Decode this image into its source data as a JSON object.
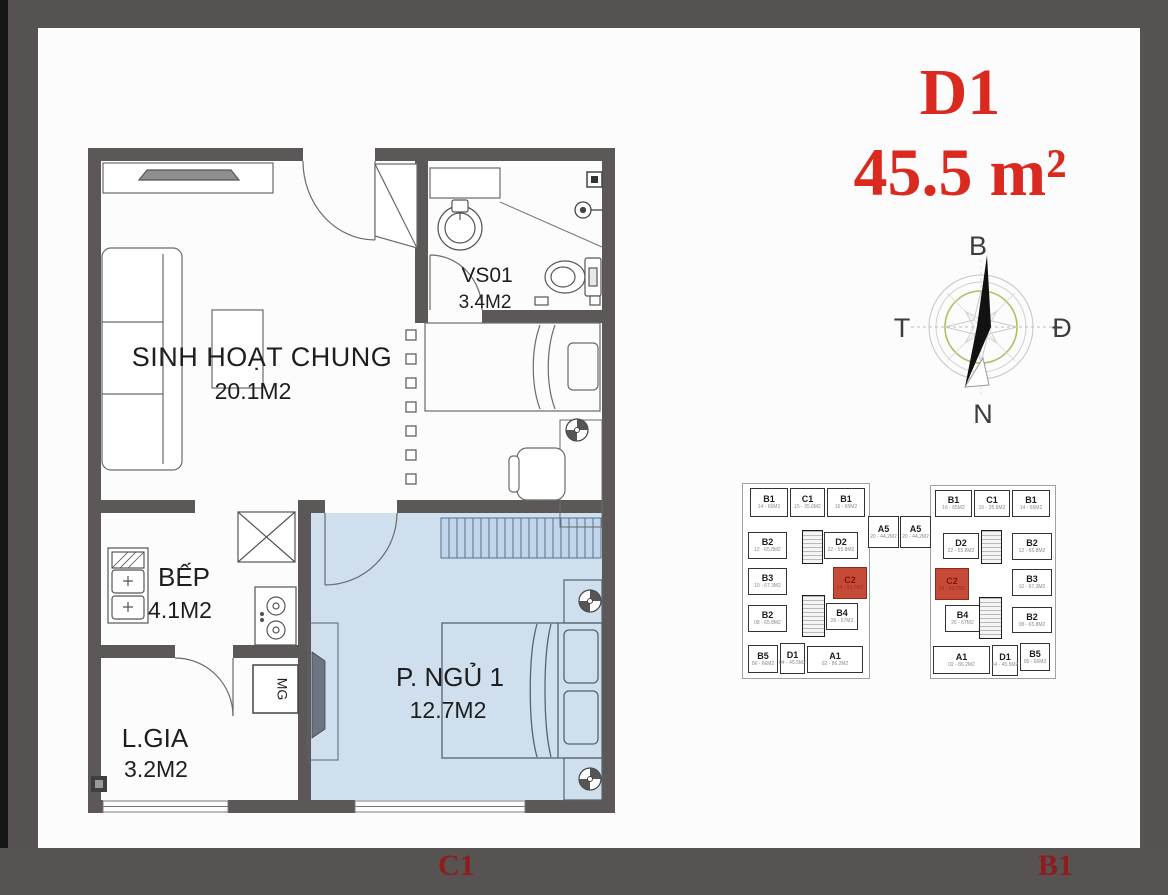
{
  "title": {
    "unit": "D1",
    "area": "45.5 m²"
  },
  "compass": {
    "north": "B",
    "east": "Đ",
    "south": "N",
    "west": "T"
  },
  "floorplan": {
    "rooms": [
      {
        "name": "SINH HOẠT CHUNG",
        "area": "20.1M2"
      },
      {
        "name": "VS01",
        "area": "3.4M2"
      },
      {
        "name": "BẾP",
        "area": "4.1M2"
      },
      {
        "name": "L.GIA",
        "area": "3.2M2"
      },
      {
        "name": "P. NGỦ 1",
        "area": "12.7M2"
      }
    ],
    "appliance_label": "MG"
  },
  "keyplan": {
    "cells": [
      {
        "t": "u",
        "label": "B1",
        "sub": "14 - 65M2",
        "x": 12,
        "y": 5,
        "w": 38,
        "h": 29
      },
      {
        "t": "u",
        "label": "C1",
        "sub": "15 - 35.6M2",
        "x": 52,
        "y": 5,
        "w": 35,
        "h": 29
      },
      {
        "t": "u",
        "label": "B1",
        "sub": "16 - 65M2",
        "x": 89,
        "y": 5,
        "w": 38,
        "h": 29
      },
      {
        "t": "u",
        "label": "B2",
        "sub": "12 - 65.8M2",
        "x": 10,
        "y": 49,
        "w": 39,
        "h": 27
      },
      {
        "t": "core",
        "x": 64,
        "y": 47,
        "w": 21,
        "h": 34
      },
      {
        "t": "u",
        "label": "D2",
        "sub": "22 - 55.8M2",
        "x": 86,
        "y": 49,
        "w": 34,
        "h": 27
      },
      {
        "t": "u",
        "label": "B3",
        "sub": "10 - 67.3M2",
        "x": 10,
        "y": 85,
        "w": 39,
        "h": 27
      },
      {
        "t": "red",
        "label": "C2",
        "sub": "24 - 53.7M2",
        "x": 95,
        "y": 84,
        "w": 34,
        "h": 32
      },
      {
        "t": "core",
        "x": 64,
        "y": 112,
        "w": 23,
        "h": 42
      },
      {
        "t": "u",
        "label": "B2",
        "sub": "08 - 65.8M2",
        "x": 10,
        "y": 122,
        "w": 39,
        "h": 27
      },
      {
        "t": "u",
        "label": "B4",
        "sub": "26 - 67M2",
        "x": 88,
        "y": 120,
        "w": 32,
        "h": 27
      },
      {
        "t": "u",
        "label": "B5",
        "sub": "06 - 66M2",
        "x": 10,
        "y": 162,
        "w": 30,
        "h": 28
      },
      {
        "t": "u",
        "label": "D1",
        "sub": "04 - 45.5M2",
        "x": 42,
        "y": 160,
        "w": 25,
        "h": 31
      },
      {
        "t": "u",
        "label": "A1",
        "sub": "02 - 86.2M2",
        "x": 69,
        "y": 163,
        "w": 56,
        "h": 27
      },
      {
        "t": "u",
        "label": "A5",
        "sub": "20 - 44.2M2",
        "x": 130,
        "y": 33,
        "w": 31,
        "h": 32
      },
      {
        "t": "u",
        "label": "A5",
        "sub": "20 - 44.2M2",
        "x": 162,
        "y": 33,
        "w": 31,
        "h": 32
      },
      {
        "t": "u",
        "label": "B1",
        "sub": "16 - 65M2",
        "x": 197,
        "y": 7,
        "w": 37,
        "h": 27
      },
      {
        "t": "u",
        "label": "C1",
        "sub": "15 - 35.6M2",
        "x": 236,
        "y": 7,
        "w": 36,
        "h": 27
      },
      {
        "t": "u",
        "label": "B1",
        "sub": "14 - 65M2",
        "x": 274,
        "y": 7,
        "w": 38,
        "h": 27
      },
      {
        "t": "u",
        "label": "D2",
        "sub": "22 - 55.8M2",
        "x": 205,
        "y": 50,
        "w": 36,
        "h": 26
      },
      {
        "t": "core",
        "x": 243,
        "y": 47,
        "w": 21,
        "h": 34
      },
      {
        "t": "u",
        "label": "B2",
        "sub": "12 - 65.8M2",
        "x": 274,
        "y": 50,
        "w": 40,
        "h": 27
      },
      {
        "t": "red",
        "label": "C2",
        "sub": "24 - 53.7M2",
        "x": 197,
        "y": 85,
        "w": 34,
        "h": 32
      },
      {
        "t": "u",
        "label": "B3",
        "sub": "10 - 67.3M2",
        "x": 274,
        "y": 86,
        "w": 40,
        "h": 27
      },
      {
        "t": "u",
        "label": "B4",
        "sub": "26 - 67M2",
        "x": 207,
        "y": 122,
        "w": 35,
        "h": 27
      },
      {
        "t": "core",
        "x": 241,
        "y": 114,
        "w": 23,
        "h": 42
      },
      {
        "t": "u",
        "label": "B2",
        "sub": "08 - 65.8M2",
        "x": 274,
        "y": 124,
        "w": 40,
        "h": 26
      },
      {
        "t": "u",
        "label": "A1",
        "sub": "02 - 86.2M2",
        "x": 195,
        "y": 163,
        "w": 57,
        "h": 28
      },
      {
        "t": "u",
        "label": "D1",
        "sub": "04 - 45.5M2",
        "x": 254,
        "y": 162,
        "w": 26,
        "h": 31
      },
      {
        "t": "u",
        "label": "B5",
        "sub": "06 - 66M2",
        "x": 282,
        "y": 160,
        "w": 30,
        "h": 28
      }
    ]
  },
  "footer": {
    "left_label": "C1",
    "right_label": "B1"
  },
  "colors": {
    "frame": "#575252",
    "wall": "#5d5858",
    "bedroom_fill": "#cfdfee",
    "title_red": "#da2a20",
    "footer_red": "#8f1c1c",
    "keyplan_highlight": "#c64a38",
    "compass_green": "#a9c262"
  }
}
